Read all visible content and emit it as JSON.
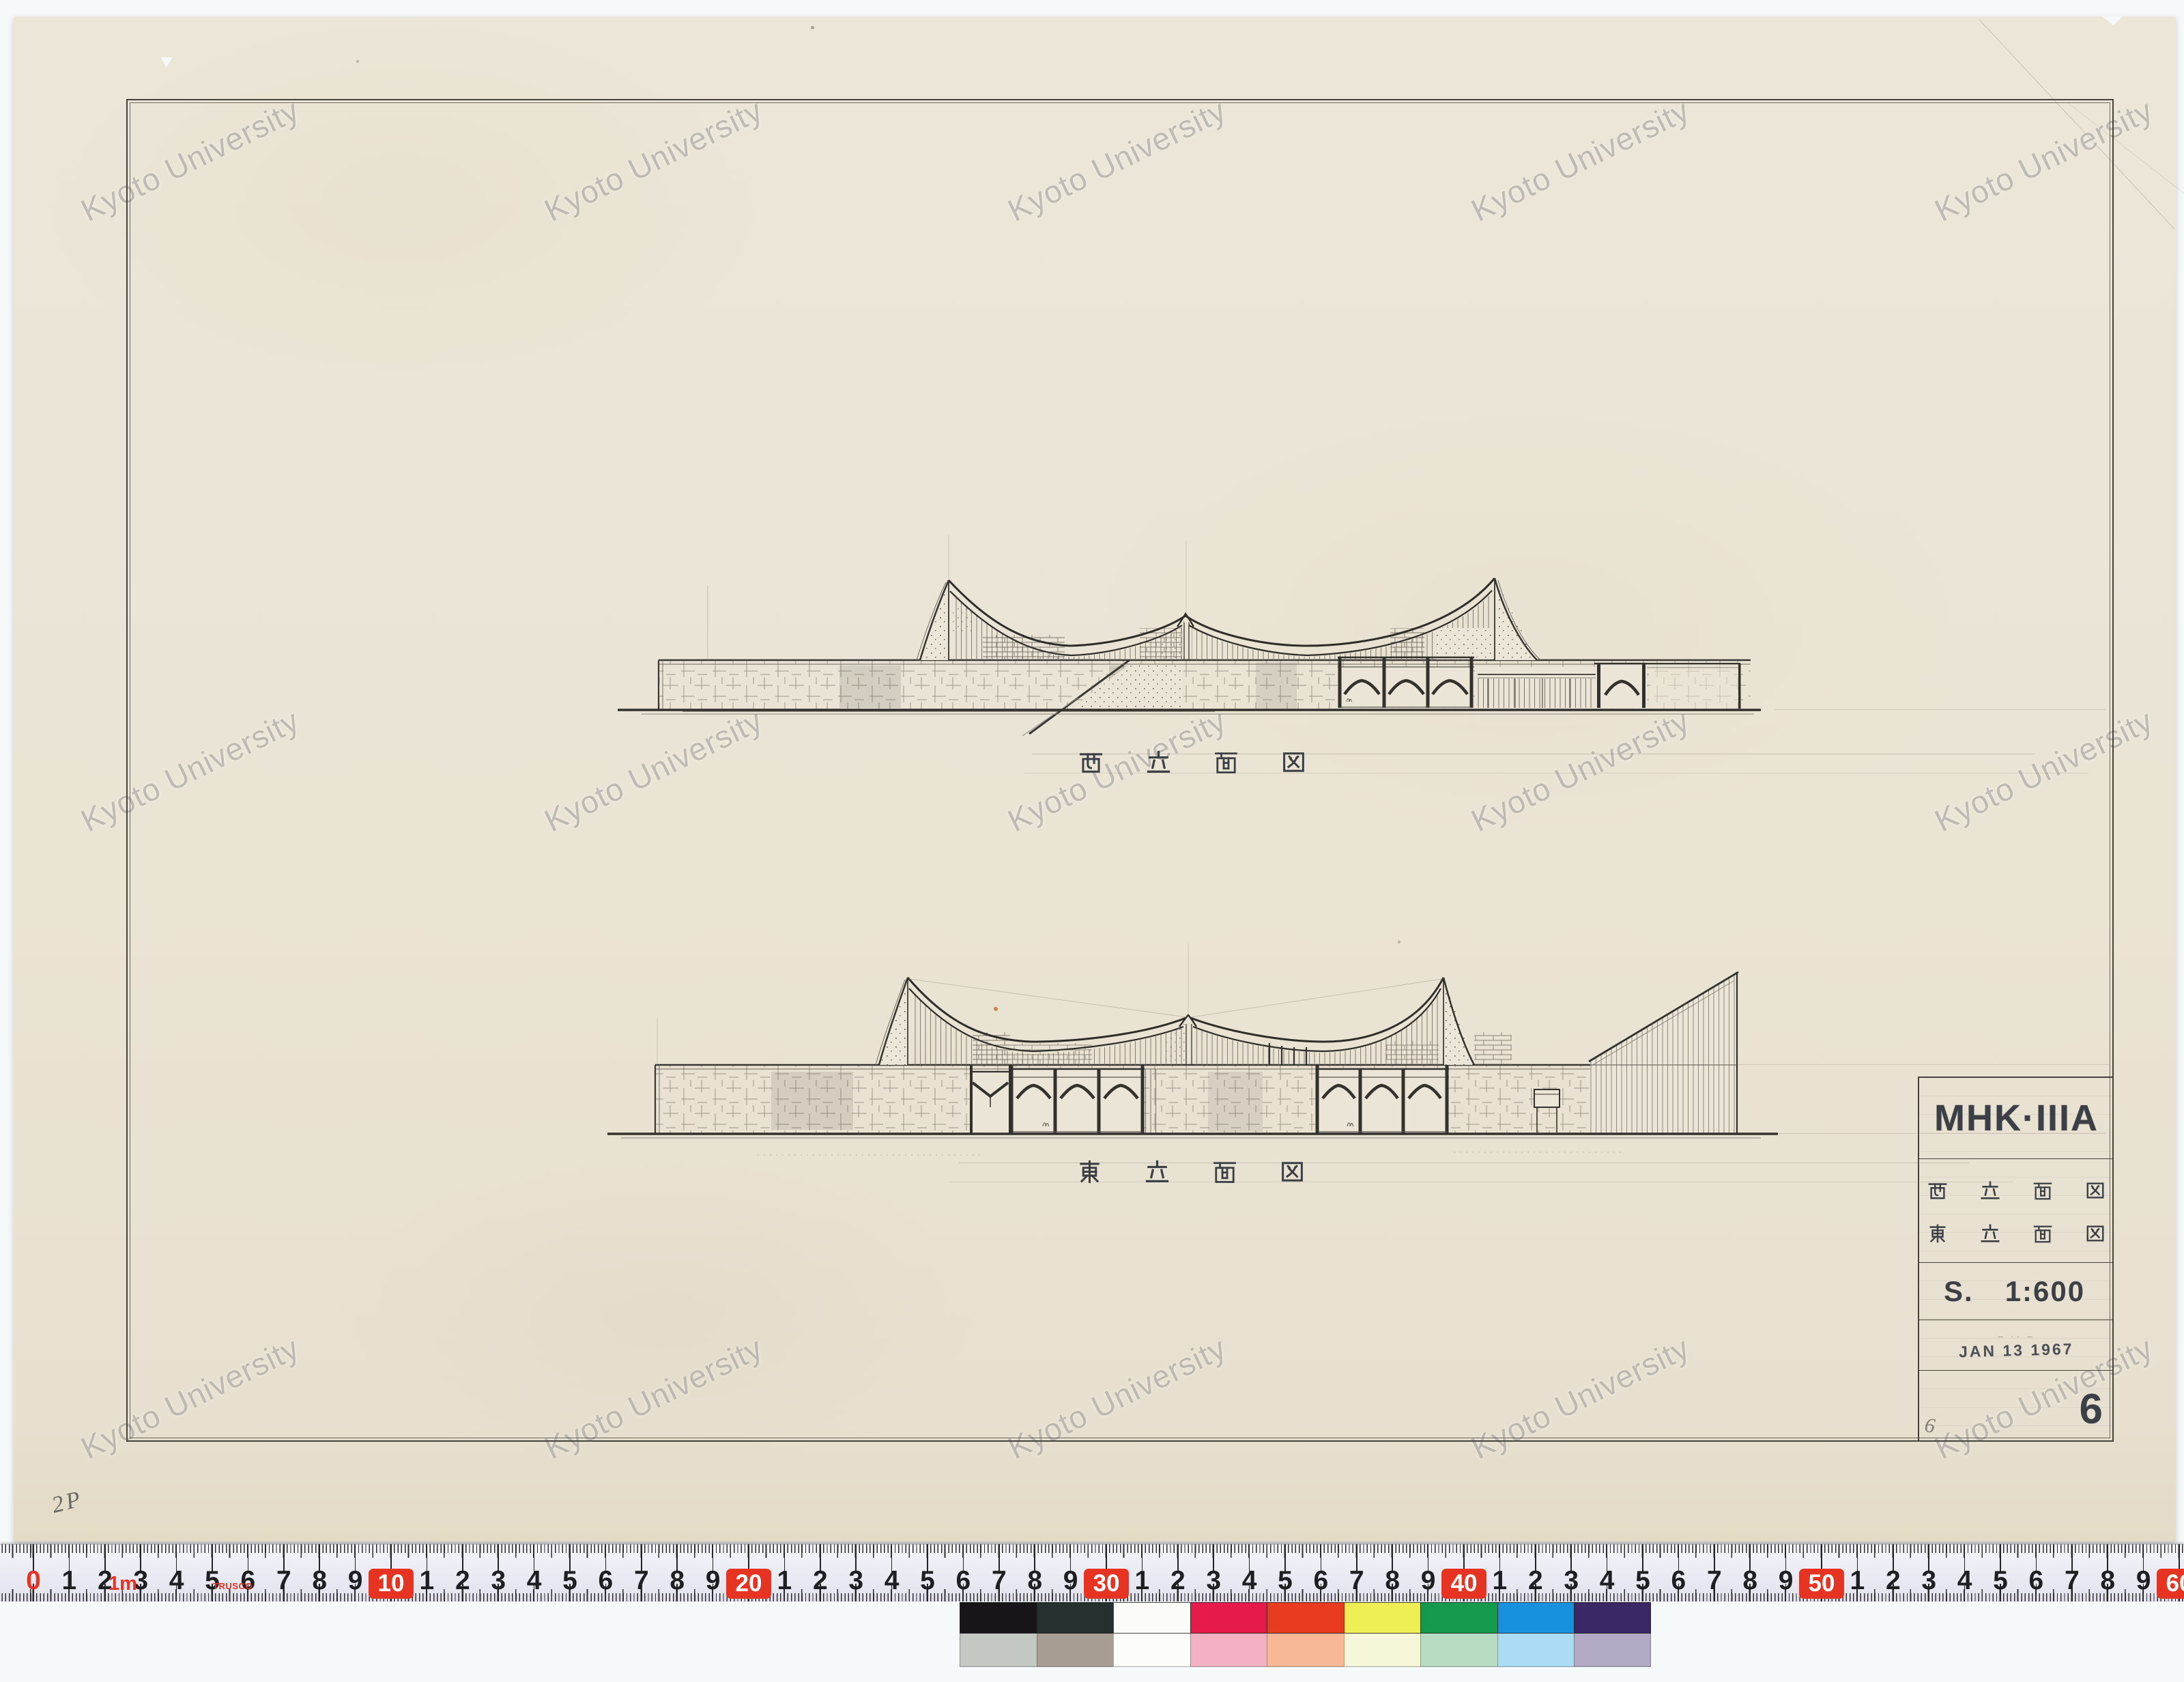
{
  "watermark": {
    "text": "Kyoto University"
  },
  "drawings": {
    "west": {
      "label": "西立面図"
    },
    "east": {
      "label": "東立面図"
    }
  },
  "title_block": {
    "project_code": "MHK·IIIA",
    "row_west": "西立面図",
    "row_east": "東立面図",
    "scale_prefix": "S.",
    "scale_value": "1:600",
    "date_dashes": "–  ··  –",
    "date_stamp": "JAN 13 1967",
    "sheet_number": "6",
    "pencil_sheet_note": "6"
  },
  "annotations": {
    "corner_note": "2P"
  },
  "ruler": {
    "brand": "TRUSCO",
    "meter_label": "1m",
    "cm_total": 60,
    "red_decades": [
      10,
      20,
      30,
      40,
      50,
      60
    ],
    "red_color": "#e63322",
    "number_color": "#1e1f22"
  },
  "color_bar": {
    "top": [
      "#17141a",
      "#25312f",
      "#fbfbf8",
      "#e61a4b",
      "#e93b20",
      "#eeee55",
      "#149a4d",
      "#1691dd",
      "#3a2766"
    ],
    "bottom": [
      "#c3c9c2",
      "#a89d93",
      "#fcfcf9",
      "#f3b1c3",
      "#f8b795",
      "#f6f6d8",
      "#b7dcc1",
      "#abdcf3",
      "#b2aac5"
    ]
  }
}
